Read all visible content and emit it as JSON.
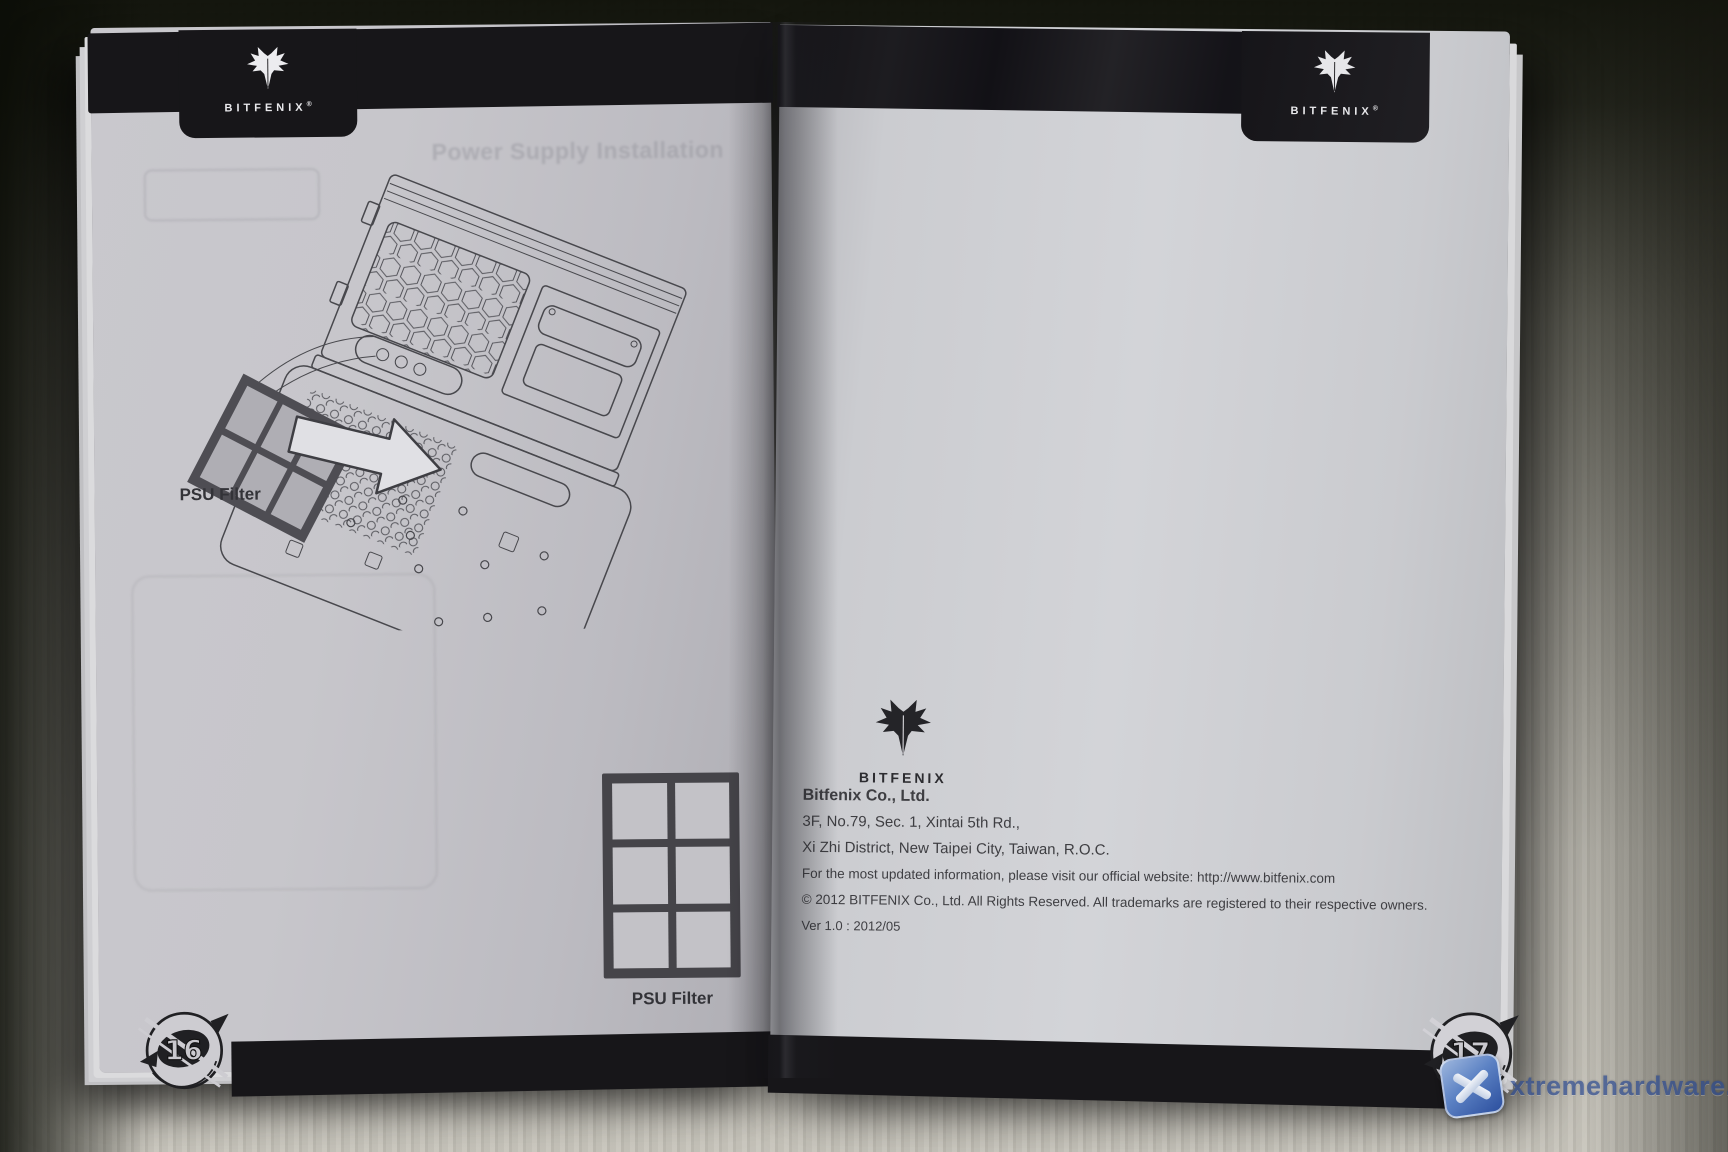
{
  "brand": {
    "wordmark": "BITFENIX",
    "registered_mark": "®"
  },
  "left_page": {
    "page_number": "16",
    "ghost_title": "Power Supply Installation",
    "diagram_label": "PSU Filter",
    "figure_label": "PSU Filter"
  },
  "right_page": {
    "page_number": "17",
    "company_name": "Bitfenix Co., Ltd.",
    "address_line1": "3F, No.79, Sec. 1, Xintai 5th Rd.,",
    "address_line2": "Xi Zhi District, New Taipei City, Taiwan, R.O.C.",
    "info_line": "For the most updated information, please visit our official website: http://www.bitfenix.com",
    "copyright_line": "© 2012 BITFENIX Co., Ltd. All Rights Reserved. All trademarks are registered to their respective owners.",
    "version_line": "Ver 1.0 : 2012/05"
  },
  "watermark": {
    "text": "xtremehardware.com"
  },
  "colors": {
    "band_black": "#171619",
    "page_tint": "#c7c6cb",
    "print_ink": "#323236",
    "watermark_blue": "#2c4a90"
  }
}
